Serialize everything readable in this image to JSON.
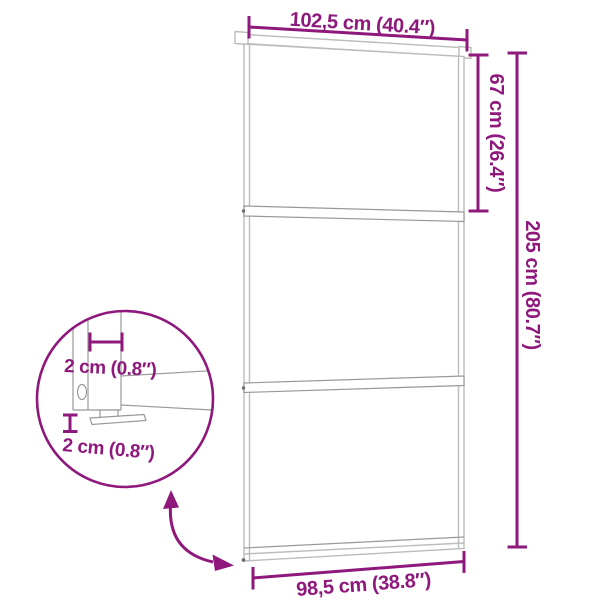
{
  "colors": {
    "accent": "#8E187C",
    "line_light": "#BCBCBC",
    "line_mid": "#999999",
    "background": "#FFFFFF"
  },
  "figure": {
    "subject": "sliding-glass-door-dimension-diagram",
    "panel_count": 3
  },
  "dimensions": {
    "top_width": "102,5 cm (40.4″)",
    "upper_height": "67 cm (26.4″)",
    "full_height": "205 cm (80.7″)",
    "bottom_width": "98,5 cm (38.8″)",
    "detail_width": "2 cm (0.8″)",
    "detail_gap": "2 cm (0.8″)"
  },
  "icons": {
    "zoom_arrow": "curved-double-arrow",
    "detail_circle": "zoom-callout-circle"
  }
}
